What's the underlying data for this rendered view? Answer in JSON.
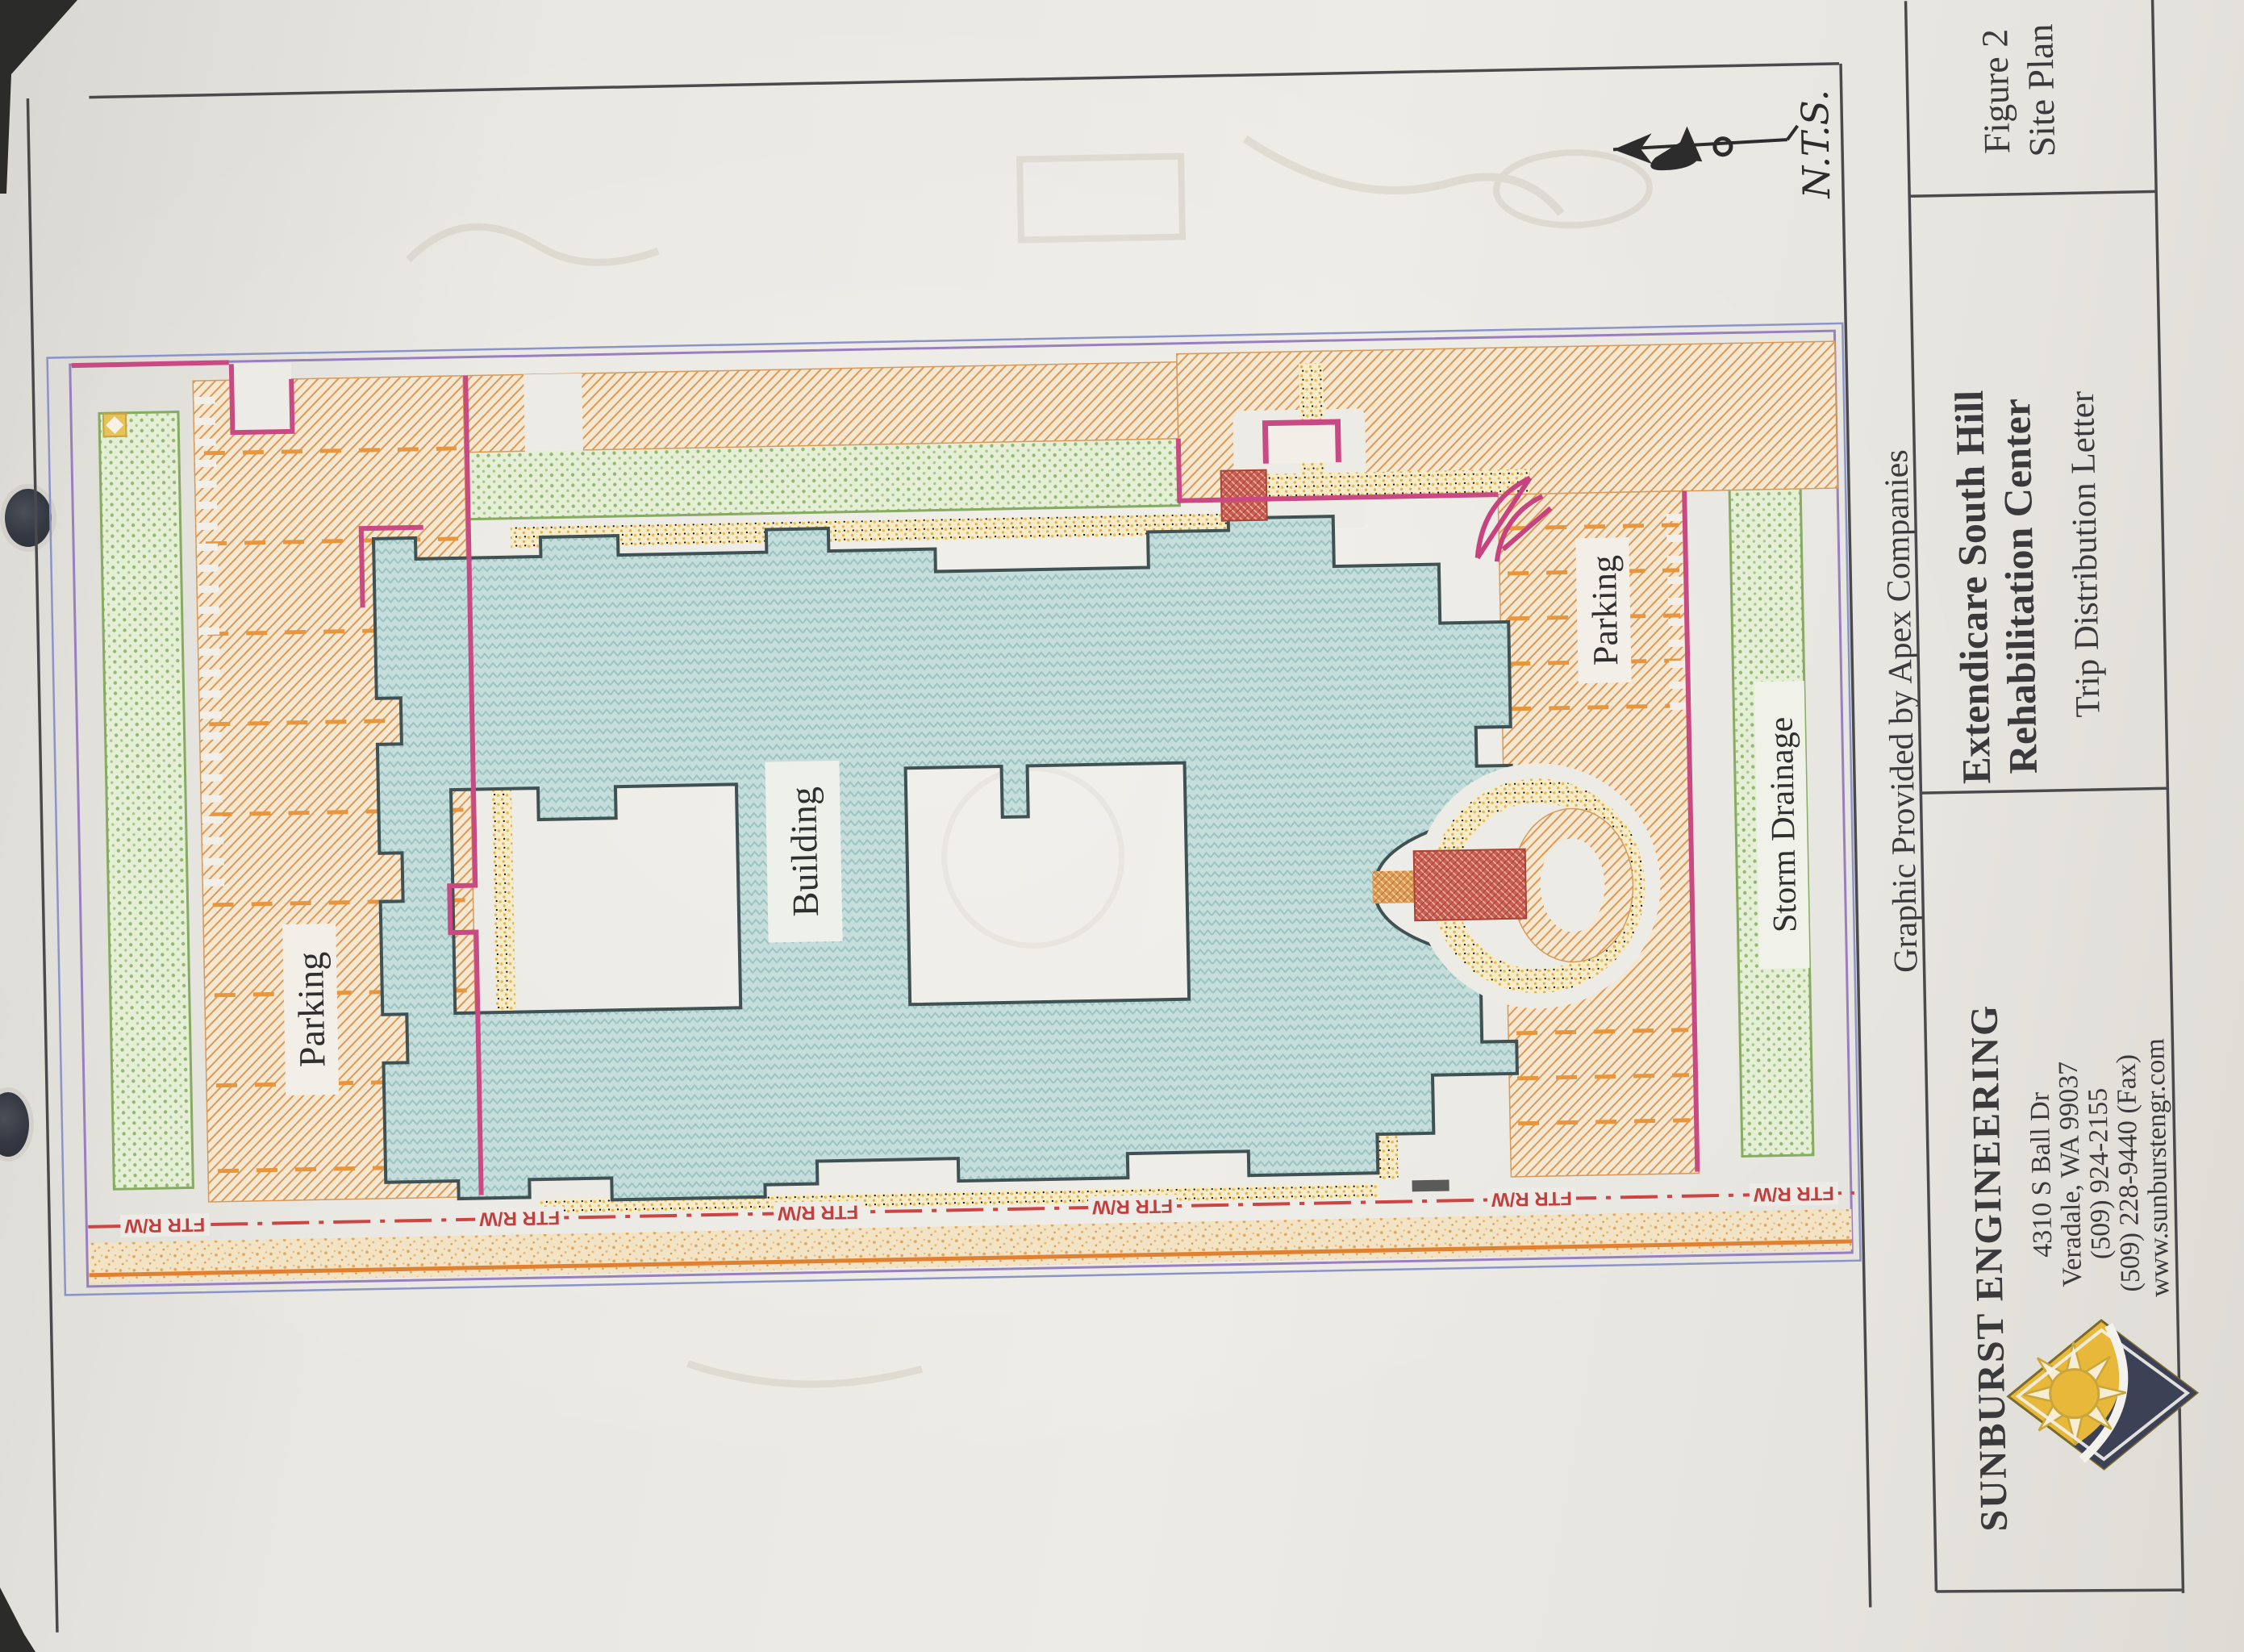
{
  "plan": {
    "labels": {
      "parking_left": "Parking",
      "building": "Building",
      "parking_right": "Parking",
      "storm_drainage": "Storm Drainage"
    },
    "scale_note": "N.T.S.",
    "right_of_way_label": "FTR R/W"
  },
  "credit": "Graphic Provided by Apex Companies",
  "title_block": {
    "figure": "Figure 2",
    "figure_subtitle": "Site Plan",
    "project_line1": "Extendicare South Hill",
    "project_line2": "Rehabilitation Center",
    "document": "Trip Distribution Letter",
    "firm": {
      "name": "SUNBURST ENGINEERING",
      "address_line1": "4310 S Ball Dr",
      "address_line2": "Veradale, WA 99037",
      "phone": "(509) 924-2155",
      "fax": "(509) 228-9440 (Fax)",
      "website": "www.sunburstengr.com"
    }
  },
  "colors": {
    "building_fill": "#c4dddb",
    "building_outline": "#3f5152",
    "parking_hatch": "#d89a5c",
    "landscape_green": "#93b874",
    "curb_magenta": "#c94a82",
    "boundary_purple": "#9a7fc0",
    "boundary_blue": "#8a94c8",
    "right_of_way_red": "#c04040",
    "walk_yellow": "#e2bb55",
    "logo_gold": "#e8b83a",
    "logo_navy": "#3d4156"
  }
}
